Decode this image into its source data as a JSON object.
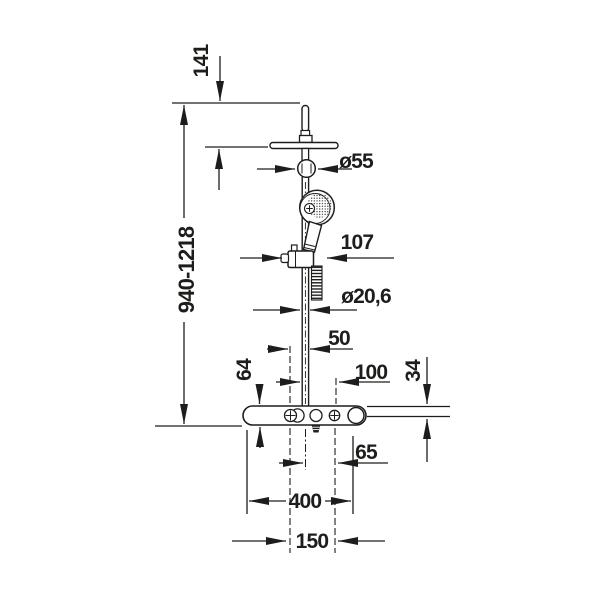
{
  "page": {
    "type": "technical-dimension-drawing",
    "subject": "shower column with overhead shower, hand shower and mixer bar",
    "background_color": "#ffffff",
    "line_color": "#1d1d1b"
  },
  "dimensions": {
    "top_offset": "141",
    "height_range": "940-1218",
    "head_joint_diameter": "ø55",
    "slider_width": "107",
    "pipe_diameter": "ø20,6",
    "valve_to_pipe": "50",
    "mixer_body_height": "64",
    "pipe_to_valve_right": "100",
    "profile_thickness": "34",
    "outlet_to_valve": "65",
    "mixer_width": "400",
    "valve_spacing": "150"
  }
}
